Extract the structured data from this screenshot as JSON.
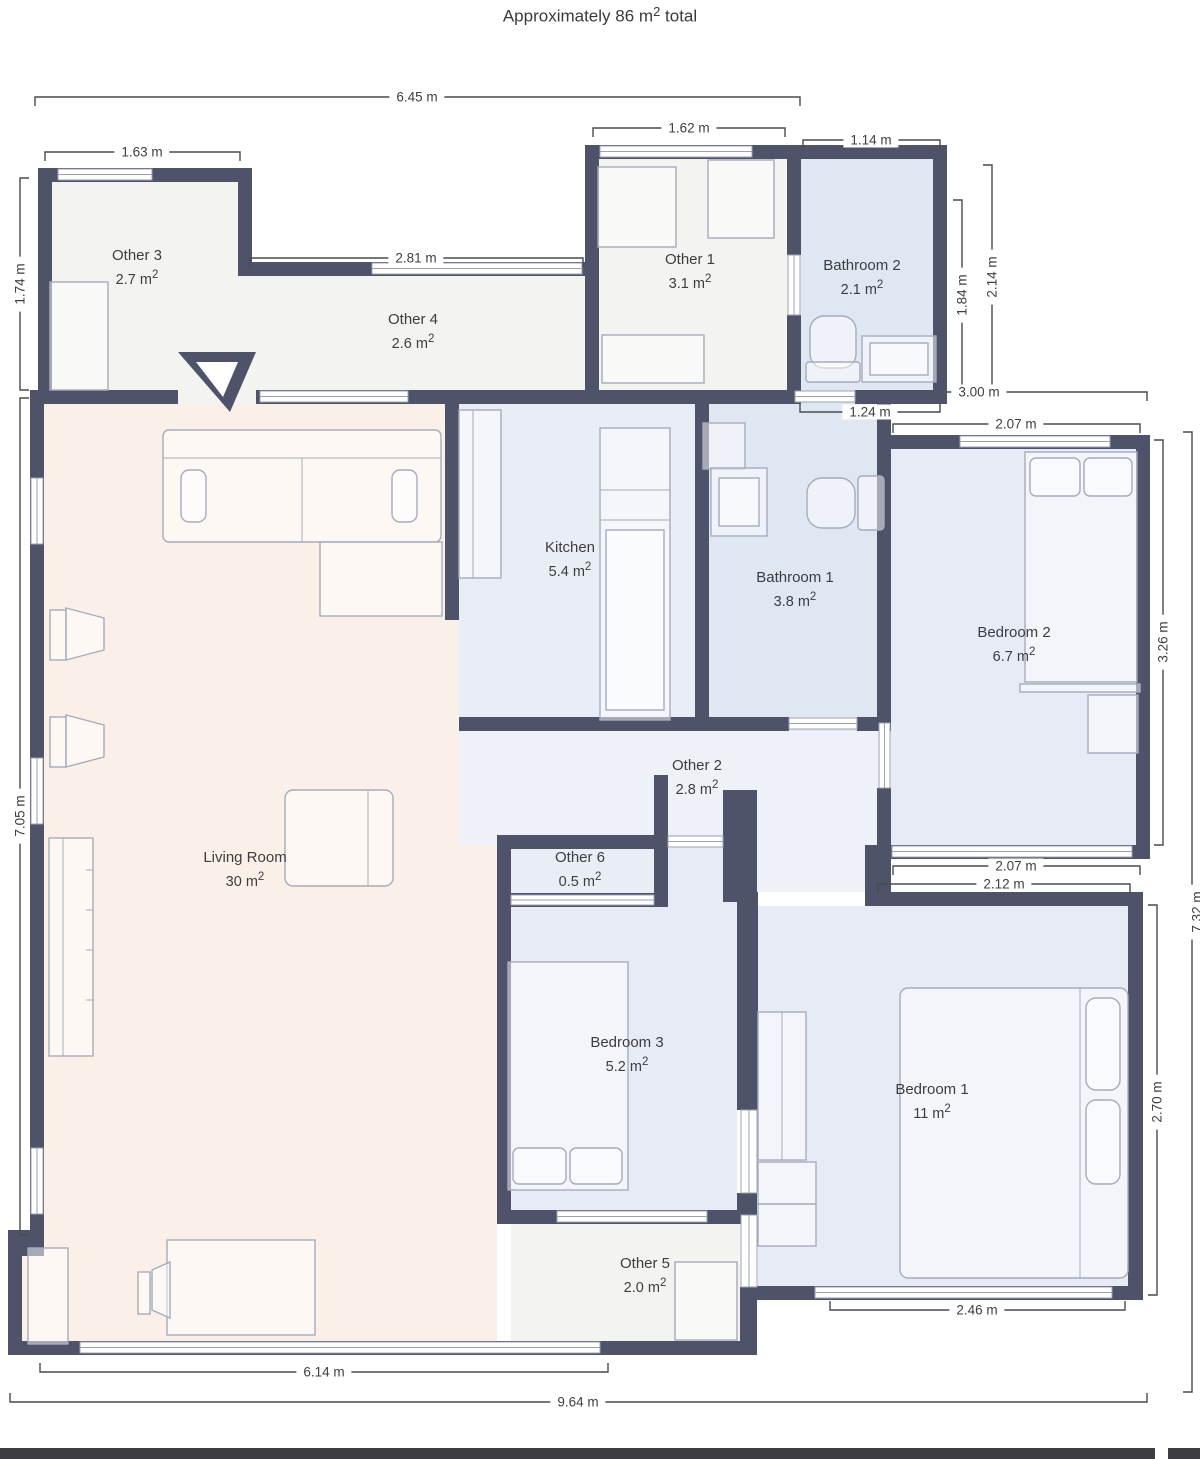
{
  "title": {
    "prefix": "Approximately 86 ",
    "unit": "m",
    "sup": "2",
    "suffix": " total"
  },
  "units": {
    "m": " m",
    "sup": "2"
  },
  "rooms": {
    "other3": {
      "name": "Other 3",
      "area": "2.7"
    },
    "other4": {
      "name": "Other 4",
      "area": "2.6"
    },
    "other1": {
      "name": "Other 1",
      "area": "3.1"
    },
    "bathroom2": {
      "name": "Bathroom 2",
      "area": "2.1"
    },
    "kitchen": {
      "name": "Kitchen",
      "area": "5.4"
    },
    "bathroom1": {
      "name": "Bathroom 1",
      "area": "3.8"
    },
    "bedroom2": {
      "name": "Bedroom 2",
      "area": "6.7"
    },
    "other2": {
      "name": "Other 2",
      "area": "2.8"
    },
    "other6": {
      "name": "Other 6",
      "area": "0.5"
    },
    "living_room": {
      "name": "Living Room",
      "area": "30"
    },
    "bedroom3": {
      "name": "Bedroom 3",
      "area": "5.2"
    },
    "bedroom1": {
      "name": "Bedroom 1",
      "area": "11"
    },
    "other5": {
      "name": "Other 5",
      "area": "2.0"
    }
  },
  "dims": {
    "top_width": "6.45 m",
    "other3_width": "1.63 m",
    "other3_height": "1.74 m",
    "other4_width": "2.81 m",
    "other1_width": "1.62 m",
    "bathroom2_width": "1.14 m",
    "bathroom2_inner_height": "1.84 m",
    "bathroom2_outer_height": "2.14 m",
    "right_upper_width": "3.00 m",
    "bathroom2_bottom_width": "1.24 m",
    "bedroom2_top_width": "2.07 m",
    "bedroom2_height": "3.26 m",
    "left_height": "7.05 m",
    "bedroom2_bottom_width": "2.07 m",
    "bedroom1_top_width": "2.12 m",
    "bedroom1_height": "2.70 m",
    "right_total_height": "7.32 m",
    "bedroom1_bottom_width": "2.46 m",
    "bottom_inner_width": "6.14 m",
    "bottom_total_width": "9.64 m"
  },
  "colors": {
    "wall": "#4f536a",
    "floor_living": "#faf0e8",
    "floor_light": "#f3f3ef",
    "floor_bath": "#dfe7f3",
    "floor_bed": "#e6ebf5",
    "floor_kitchen": "#e9edf6",
    "floor_hall": "#eef1f7",
    "bottom_bar": "#3c3e44"
  }
}
